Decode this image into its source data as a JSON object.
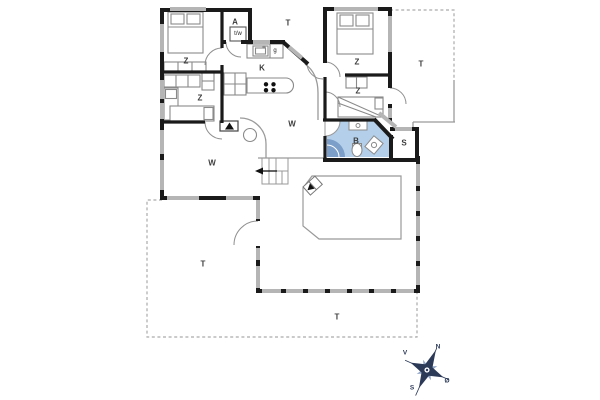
{
  "floor_plan": {
    "rooms": {
      "bedroom_nw": "Z",
      "bedroom_w": "Z",
      "bedroom_ne": "Z",
      "bedroom_e": "Z",
      "entry": "A",
      "kitchen": "K",
      "living_center": "W",
      "living_sw": "W",
      "bathroom": "B",
      "sauna": "S",
      "terrace_north": "T",
      "terrace_east": "T",
      "terrace_sw": "T",
      "terrace_south": "T"
    },
    "fixtures": {
      "washer_dryer": "t/w",
      "stove": "g"
    },
    "compass": {
      "north": "N",
      "west": "V",
      "south": "S",
      "east": "Ø"
    },
    "colors": {
      "wall": "#1a1a1a",
      "window": "#b5b5b5",
      "bathroom_fill": "#b4cfe9",
      "shower_fill": "#7c9fc9",
      "compass_dark": "#2c3a58",
      "compass_light": "#93a7c7"
    }
  }
}
